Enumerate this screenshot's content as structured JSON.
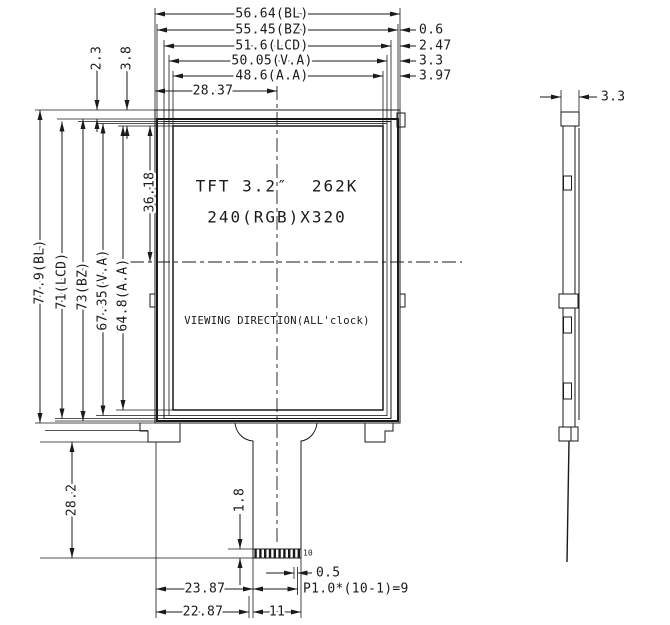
{
  "front_view": {
    "screen": {
      "line1": "TFT 3.2″  262K",
      "line2": "240(RGB)X320",
      "viewing_direction": "VIEWING DIRECTION(ALL'clock)"
    },
    "width_dims": {
      "bl": "56.64(BL)",
      "bz": "55.45(BZ)",
      "lcd": "51.6(LCD)",
      "va": "50.05(V.A)",
      "aa": "48.6(A.A)",
      "half_width_to_center": "28.37"
    },
    "right_edge_offsets": {
      "bz": "0.6",
      "lcd": "2.47",
      "va": "3.3",
      "aa": "3.97"
    },
    "top_edge_offsets": {
      "bz": "2.3",
      "aa": "3.8"
    },
    "height_dims": {
      "bl": "77.9(BL)",
      "lcd": "71(LCD)",
      "bz": "73(BZ)",
      "va": "67.35(V.A)",
      "aa": "64.8(A.A)",
      "half_height_to_center": "36.18"
    },
    "bottom": {
      "tail_drop": "28.2",
      "pin_length": "1.8",
      "pin_width": "0.5",
      "pin_pitch_formula": "P1.0*(10-1)=9",
      "pin_offset": "23.87",
      "tail_offset": "22.87",
      "tail_width": "11",
      "pin_count": "10"
    }
  },
  "side_view": {
    "thickness": "3.3"
  }
}
